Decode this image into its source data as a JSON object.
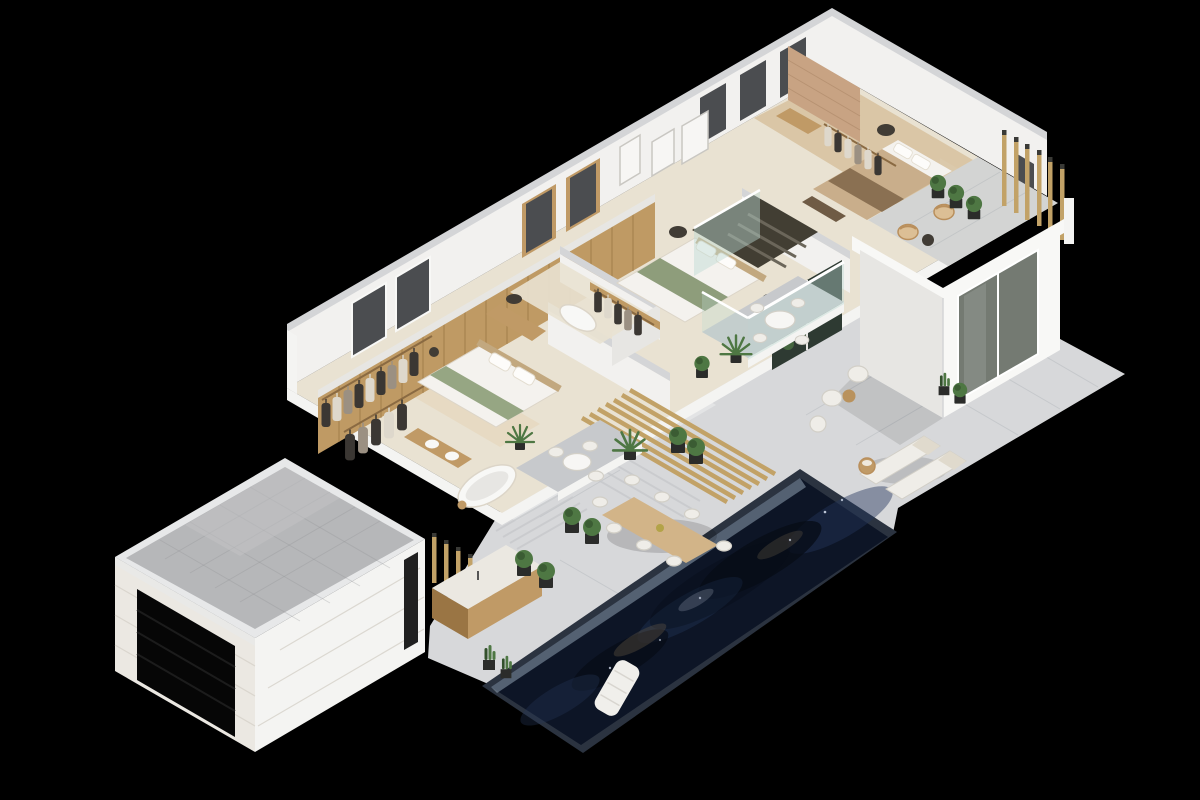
{
  "scene": {
    "description": "3D isometric cutaway render of a modern villa upper floor with pool terrace, on a black background",
    "background": "#000000",
    "elements": [
      "garage",
      "swimming-pool",
      "pool-float",
      "stone-terrace",
      "outdoor-dining-set",
      "sun-loungers",
      "outdoor-kitchen",
      "master-suite",
      "walk-in-closet",
      "master-bathroom",
      "middle-bedroom",
      "middle-closet",
      "middle-bathroom",
      "stairwell",
      "glass-balustrade",
      "balcony",
      "pergola-beams",
      "top-bedroom",
      "bedroom-closet",
      "roof-terrace",
      "slat-screens",
      "planters",
      "palms",
      "cacti"
    ]
  },
  "palette": {
    "bg": "#000000",
    "stone": "#d7d8da",
    "stoneShade": "#c7c9cc",
    "stoneLine": "#9aa0a6",
    "stepLight": "#e3e4e5",
    "travertine": "#e9e2d2",
    "woodFloor": "#d8c3a1",
    "rug": "#e6d8bf",
    "wallWhite": "#f2f1ef",
    "wallBright": "#f8f8f6",
    "wallShadow": "#e7e6e3",
    "wallCap": "#d4d5d7",
    "sectionWhite": "#f4f4f2",
    "woodWall": "#bf9a64",
    "woodWallDark": "#9a7544",
    "goldSlat": "#c2a267",
    "goldSlatDark": "#8f7340",
    "slatCap": "#3a3a36",
    "poolRim": "#2b3340",
    "poolDeep": "#0d1526",
    "poolMid": "#24365a",
    "poolDark": "#070c16",
    "poolLight": "#8fa0b0",
    "poolGlint": "#6b5c49",
    "poolSpark": "#cfd8e8",
    "floatWhite": "#f0efeb",
    "floatSeam": "#d8d5cf",
    "gravel": "#b6b7b9",
    "gravelLine": "#8f9194",
    "parapet": "#e7e8e9",
    "brick": "#ebe8e2",
    "brickLine": "#d6d2ca",
    "doorBlack": "#060606",
    "doorLine": "#1c1c1c",
    "doorFrame": "#e9e9e7",
    "windowDark": "#4b4d50",
    "windowGlass": "#747a72",
    "accentBrick": "#c8a383",
    "accentLine": "#b08b6b",
    "glassTint": "#bcd9d2",
    "railWhite": "#ffffff",
    "plantGreen": "#4e7743",
    "plantDark": "#33512c",
    "potDark": "#2b2c2a",
    "planterWood": "#a58155",
    "bedWhite": "#f4f2ee",
    "bedEdge": "#dcd5c8",
    "bedGreen": "#96a683",
    "bedGreenDark": "#8e9d7b",
    "bedTan": "#c9ae8b",
    "bedThrow": "#8a7052",
    "headboard": "#c2a87f",
    "benchBrown": "#6f5b45",
    "pillowWhite": "#fdfcfa",
    "pillowEdge": "#e3ddd0",
    "clothesDark": "#3b3733",
    "clothesLight": "#ded8cc",
    "clothesMid": "#9b9082",
    "rail": "#8a6a42",
    "stairDark": "#423e33",
    "stairStep": "#6b665a",
    "furnWhite": "#efede8",
    "furnStroke": "#d2cfc7",
    "furnWood": "#c09a66",
    "darkSeat": "#413c35",
    "wicker": "#dcbf95",
    "wickerEdge": "#b98f5c",
    "tableWood": "#d2b488",
    "bowl": "#b3a348",
    "wardrobe": "#dbc9ab",
    "artWhite": "#f7f6f4",
    "artEdge": "#c9c7c2",
    "shadow": "#000000"
  }
}
